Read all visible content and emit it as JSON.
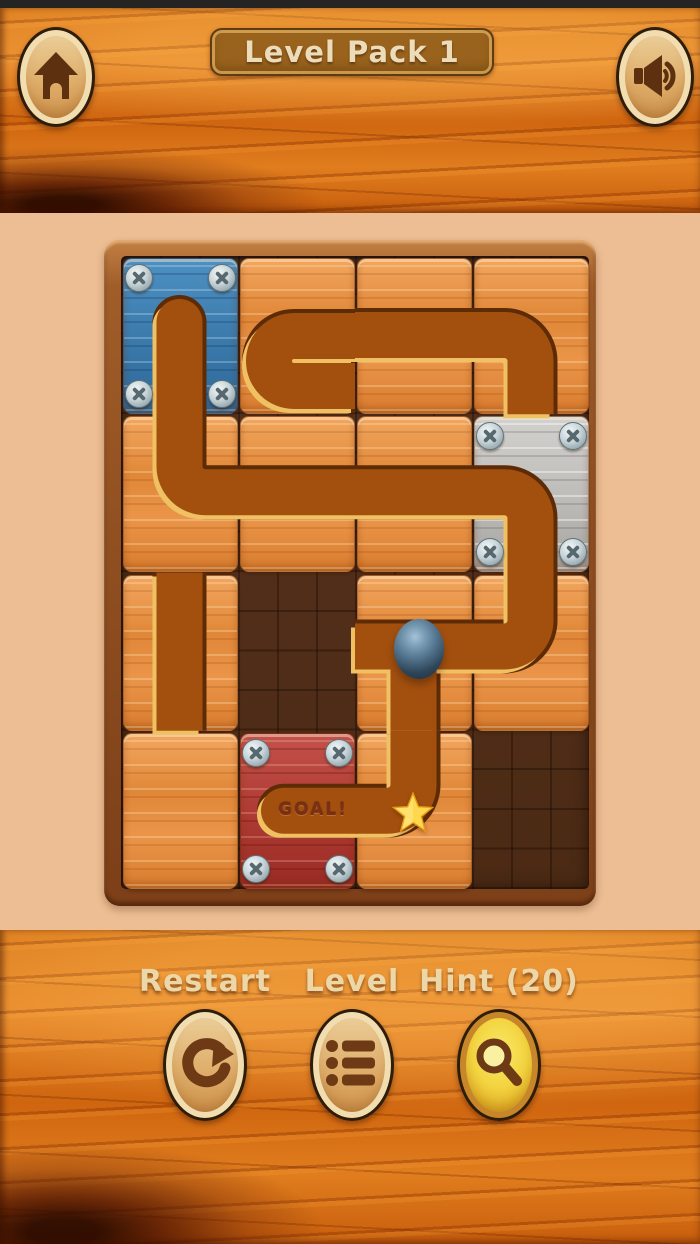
{
  "header": {
    "title": "Level Pack 1",
    "home_button": {
      "icon": "home-icon"
    },
    "sound_button": {
      "icon": "speaker-icon"
    }
  },
  "board": {
    "rows": 4,
    "cols": 4,
    "ball_icon": "ball",
    "goal_star_icon": "star-icon",
    "cells": [
      {
        "row": 1,
        "col": 1,
        "tile": "blue",
        "locked": true,
        "screws": true,
        "pipe": "dead-end-top"
      },
      {
        "row": 1,
        "col": 2,
        "tile": "wood",
        "locked": false,
        "pipe": "u-turn-right"
      },
      {
        "row": 1,
        "col": 3,
        "tile": "wood",
        "locked": false,
        "pipe": "horizontal"
      },
      {
        "row": 1,
        "col": 4,
        "tile": "wood",
        "locked": false,
        "pipe": "elbow-left-to-bottom"
      },
      {
        "row": 2,
        "col": 1,
        "tile": "wood",
        "locked": false,
        "pipe": "elbow-top-to-right"
      },
      {
        "row": 2,
        "col": 2,
        "tile": "wood",
        "locked": false,
        "pipe": "horizontal"
      },
      {
        "row": 2,
        "col": 3,
        "tile": "wood",
        "locked": false,
        "pipe": "horizontal"
      },
      {
        "row": 2,
        "col": 4,
        "tile": "gray",
        "locked": true,
        "screws": true,
        "pipe": "elbow-left-to-bottom"
      },
      {
        "row": 3,
        "col": 1,
        "tile": "wood",
        "locked": false,
        "pipe": "vertical"
      },
      {
        "row": 3,
        "col": 2,
        "tile": "none"
      },
      {
        "row": 3,
        "col": 3,
        "tile": "wood",
        "locked": false,
        "pipe": "tee-left-right-bottom",
        "ball": true
      },
      {
        "row": 3,
        "col": 4,
        "tile": "wood",
        "locked": false,
        "pipe": "elbow-top-to-left"
      },
      {
        "row": 4,
        "col": 1,
        "tile": "wood",
        "locked": false,
        "pipe": null
      },
      {
        "row": 4,
        "col": 2,
        "tile": "red",
        "locked": true,
        "screws": true,
        "pipe": "goal-dead-end-left",
        "goal_label": "GOAL!"
      },
      {
        "row": 4,
        "col": 3,
        "tile": "wood",
        "locked": false,
        "pipe": "elbow-top-to-left",
        "star": true
      },
      {
        "row": 4,
        "col": 4,
        "tile": "none"
      }
    ]
  },
  "footer": {
    "actions": [
      {
        "label": "Restart",
        "icon": "restart-icon"
      },
      {
        "label": "Level",
        "icon": "level-list-icon"
      },
      {
        "label": "Hint (20)",
        "icon": "hint-magnifier-icon"
      }
    ]
  },
  "colors": {
    "background": "#EDBD93",
    "wood_ui": "#DD7D1E",
    "pipe_fill": "#A3500F",
    "pipe_outline": "#5E2B07",
    "pipe_highlight": "#EFC163",
    "tile_wood": "#E08738",
    "tile_blue": "#3A79AA",
    "tile_gray": "#BCBBB7",
    "tile_red": "#AD3A32",
    "star": "#FFD84D",
    "ball": "#53758E"
  }
}
